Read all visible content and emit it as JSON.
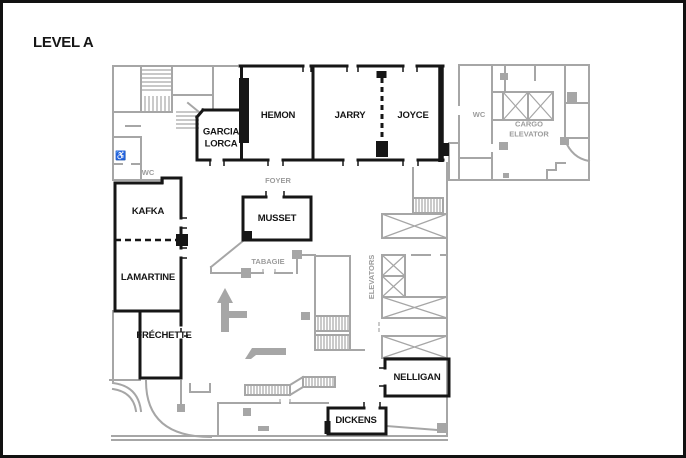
{
  "title": "LEVEL A",
  "rooms": {
    "hemon": "HEMON",
    "jarry": "JARRY",
    "joyce": "JOYCE",
    "garcia_lorca": "GARCIA\nLORCA",
    "kafka": "KAFKA",
    "musset": "MUSSET",
    "lamartine": "LAMARTINE",
    "frechette": "FRÉCHETTE",
    "nelligan": "NELLIGAN",
    "dickens": "DICKENS"
  },
  "areas": {
    "foyer": "FOYER",
    "tabagie": "TABAGIE",
    "wc_west": "WC",
    "wc_east": "WC",
    "cargo_elevator": "CARGO\nELEVATOR",
    "elevators": "ELEVATORS"
  },
  "icons": {
    "accessible": "♿"
  },
  "colors": {
    "wall_black": "#161616",
    "wall_gray": "#a6a6a6",
    "label_gray": "#9c9c9c",
    "background": "#ffffff",
    "border": "#111111"
  }
}
